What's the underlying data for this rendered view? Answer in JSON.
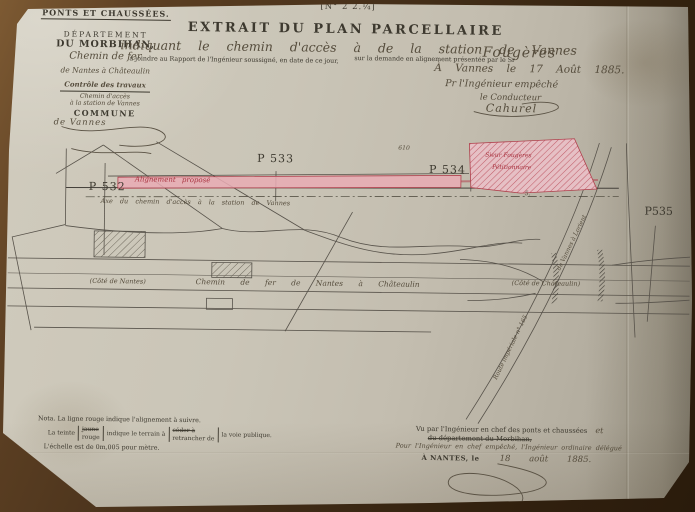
{
  "photo": {
    "table_color": "#46301a",
    "paper_color": "#c8c2b3"
  },
  "header": {
    "doc_number": "[N° 2 2.¼]",
    "title": "EXTRAIT DU PLAN PARCELLAIRE",
    "left_block": {
      "service": "PONTS ET CHAUSSÉES.",
      "departement_line1": "DÉPARTEMENT",
      "departement_line2": "DU MORBIHAN,",
      "railway_line1": "Chemin de fer",
      "railway_line2": "de Nantes à Châteaulin",
      "controle": "Contrôle des travaux",
      "acces_line1": "Chemin d'accès",
      "acces_line2": "à la station de Vannes",
      "commune_label": "COMMUNE",
      "commune_value": "de Vannes"
    },
    "subject_handwritten": "indiquant le chemin d'accès à de la station de Vannes",
    "attach_printed": "à joindre au Rapport de l'Ingénieur soussigné, en date de ce jour,",
    "request_printed": "sur la demande en alignement présentée par le Sr",
    "petitioner": "Fougères",
    "place_date": "À Vannes le 17 Août 1885.",
    "for_engineer": "Pr l'Ingénieur empêché",
    "conductor_title": "le Conducteur",
    "conductor_signature": "Cahurel"
  },
  "plan": {
    "markers": [
      {
        "label": "P 532"
      },
      {
        "label": "P 533"
      },
      {
        "label": "P 534"
      },
      {
        "label": "P535"
      }
    ],
    "parcel_number": "610",
    "lot_number": "5.",
    "alignment_label": "Alignement proposé",
    "axis_label": "Axe du chemin d'accès à la station de Vannes",
    "parcel_owner_line1": "Sieur Fougères",
    "parcel_owner_line2": "Pétitionnaire",
    "railway_label": "Chemin de fer de Nantes à Châteaulin",
    "side_left": "(Côté de Nantes)",
    "side_right": "(Côté de Châteaulin)",
    "road_label_line1": "Route impériale n° 165",
    "road_label_line2": "de Vannes à Lorient",
    "colors": {
      "alignment_pink": "#e9abb4",
      "alignment_red": "#b0424e",
      "drawing_ink": "#57524a"
    }
  },
  "legend": {
    "nota": "Nota. La ligne rouge indique l'alignement à suivre.",
    "tint_prefix": "La teinte",
    "tint_option_struck": "jaune",
    "tint_option_kept": "rouge",
    "tint_middle": "indique le terrain à",
    "action_option_struck": "céder à",
    "action_option_kept": "retrancher de",
    "tint_suffix": "la voie publique.",
    "scale": "L'échelle est de 0m,005 pour mètre."
  },
  "approval": {
    "vu_printed": "Vu par l'Ingénieur en chef des ponts et chaussées",
    "vu_added": "et",
    "struck_printed": "du département du Morbihan,",
    "delegation_handwritten": "Pour l'Ingénieur en chef empêché, l'Ingénieur ordinaire délégué",
    "place_printed": "À NANTES, le",
    "date_handwritten": "18 août 1885."
  }
}
